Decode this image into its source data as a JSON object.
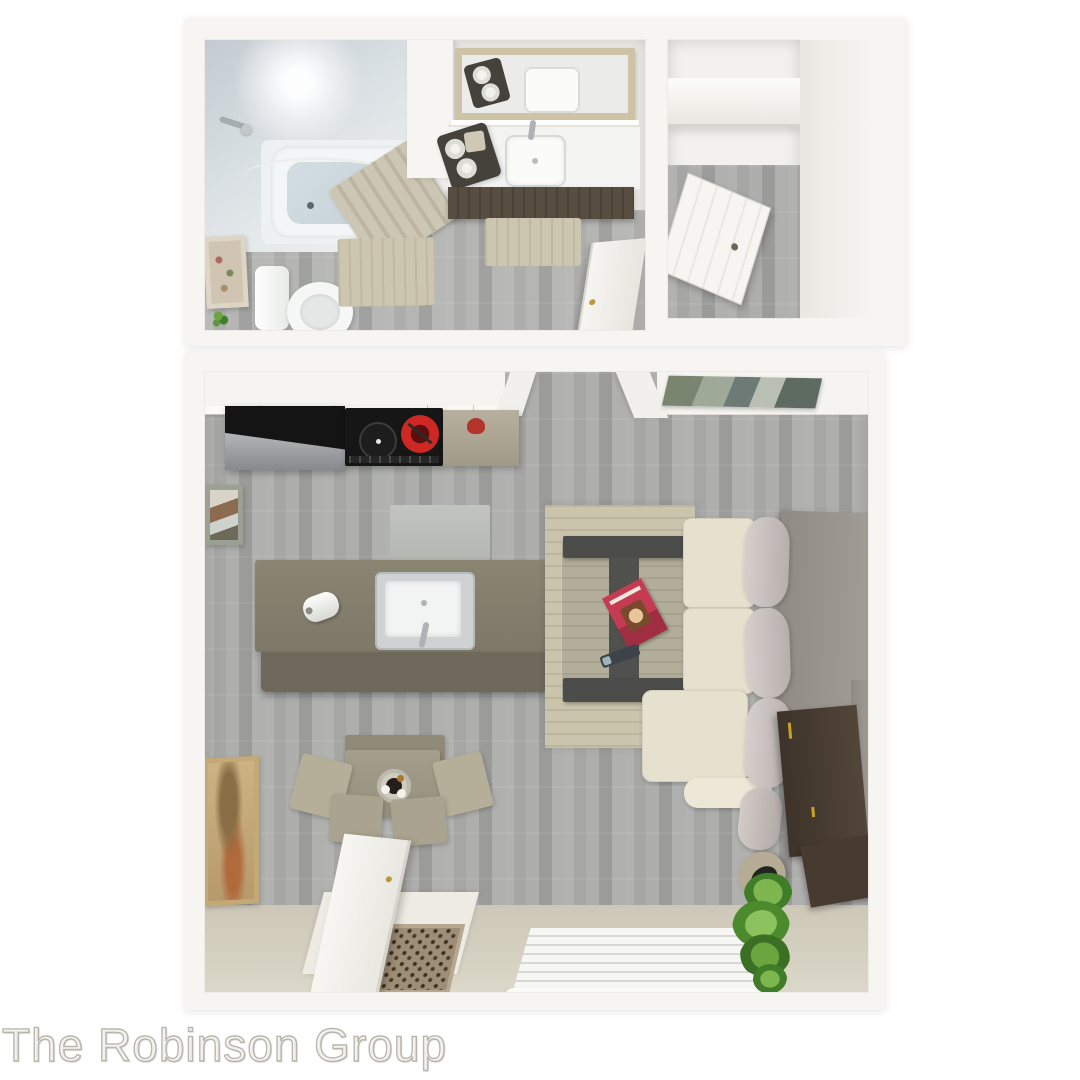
{
  "watermark": {
    "text": "The Robinson Group"
  },
  "palette": {
    "background": "#ffffff",
    "wall_white": "#f5f4f0",
    "floor_wood_gray": "#a8a9a7",
    "floor_entry_beige": "#d6d2c2",
    "tile_blue_gray": "#cdd4d8",
    "island_taupe": "#857f6e",
    "cabinet_dark_wood": "#574d41",
    "appliance_black": "#161616",
    "burner_red": "#cd2823",
    "stainless": "#c9cbcb",
    "sofa_cream": "#e6e1ce",
    "pillow_gray": "#c7c0bd",
    "sofa_back_gray": "#95918a",
    "console_brown": "#463a2e",
    "handle_gold": "#c9a227",
    "rug_beige": "#cbc4ad",
    "curtain_beige": "#c6bfac",
    "mirror_frame_tan": "#cfc3a7",
    "plant_green": "#58993a",
    "magazine_pink": "#c43b52"
  },
  "floorplan": {
    "type": "studio-apartment-3d-top-view",
    "rooms": [
      {
        "name": "bathroom",
        "fixtures": [
          "bathtub",
          "shower-head",
          "shower-curtain",
          "toilet",
          "wall-art",
          "bath-rug",
          "small-plant"
        ]
      },
      {
        "name": "vanity-area",
        "fixtures": [
          "mirror",
          "vanity-counter",
          "sink",
          "faucet",
          "towel-basket",
          "vanity-cabinet",
          "rug",
          "open-door"
        ]
      },
      {
        "name": "closet",
        "fixtures": [
          "shelf",
          "open-door"
        ]
      },
      {
        "name": "kitchen",
        "fixtures": [
          "upper-cabinets",
          "refrigerator",
          "cooktop-red-burner",
          "counter",
          "kettle",
          "kitchen-mat",
          "island",
          "kitchen-sink",
          "paper-towel-roll"
        ]
      },
      {
        "name": "dining-area",
        "fixtures": [
          "dining-table",
          "fruit-bowl",
          "bench",
          "chairs",
          "tall-wall-art",
          "small-wall-art"
        ]
      },
      {
        "name": "living-room",
        "fixtures": [
          "area-rug",
          "glass-coffee-table",
          "magazine",
          "remote",
          "sectional-sofa",
          "back-pillows",
          "sofa-back-panel",
          "media-console",
          "potted-plant",
          "landscape-art",
          "window-blinds"
        ]
      },
      {
        "name": "entry",
        "fixtures": [
          "entry-door",
          "patterned-doormat",
          "threshold"
        ]
      }
    ]
  }
}
